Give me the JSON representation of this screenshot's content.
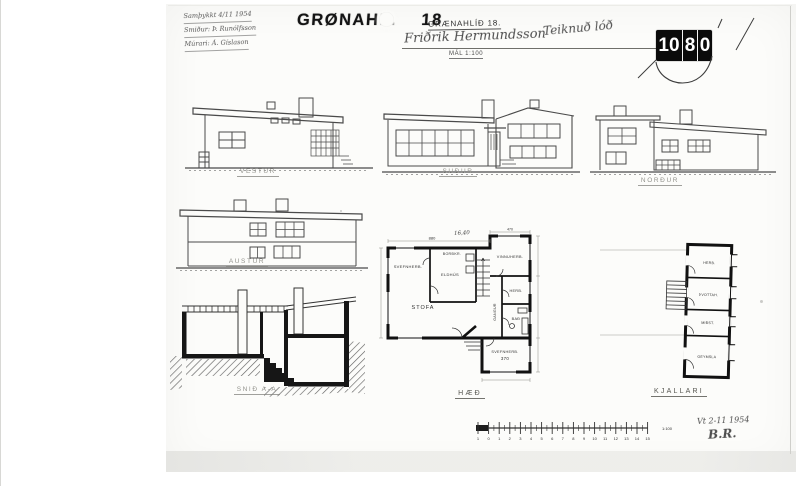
{
  "document": {
    "stamp": {
      "name": "GRØNAHL.",
      "number": "18"
    },
    "title_block": {
      "address": "GRÆNAHLÍÐ 18.",
      "owner": "Friðrik Hermundsson",
      "scale_note": "MÁL 1:100",
      "side_note": "Teiknuð lóð"
    },
    "approval_notes": {
      "line1": "Samþykkt 4/11 1954",
      "line2": "Smiður: Þ. Runólfsson",
      "line3": "Múrari: Á. Gíslason"
    },
    "plate_number": {
      "d1": "10",
      "d2": "8",
      "d3": "0"
    },
    "signature": {
      "date": "Vt 2-11 1954",
      "initials": "B.R."
    }
  },
  "drawings": {
    "elevations": [
      {
        "label": "VESTUR"
      },
      {
        "label": "SUÐUR"
      },
      {
        "label": "NORÐUR"
      },
      {
        "label": "AUSTUR"
      }
    ],
    "section": {
      "label": "SNIÐ A-A"
    },
    "floor_plan": {
      "label": "HÆÐ",
      "rooms": [
        {
          "name": "SVEFNHERB."
        },
        {
          "name": "BORÐKR."
        },
        {
          "name": "ELDHÚS"
        },
        {
          "name": "STOFA"
        },
        {
          "name": "VINNUHERB."
        },
        {
          "name": "HERB."
        },
        {
          "name": "BAÐ"
        },
        {
          "name": "GANGUR"
        },
        {
          "name": "SVEFNHERB.",
          "dim": "370"
        }
      ],
      "dimensions": {
        "top": "880",
        "top_hand": "16,40",
        "wing_top": "470"
      }
    },
    "basement_plan": {
      "label": "KJALLARI",
      "rooms": [
        {
          "name": "HERB."
        },
        {
          "name": "ÞVOTTAH."
        },
        {
          "name": "MIÐST."
        },
        {
          "name": "GEYMSLA"
        }
      ]
    }
  },
  "scale_bar": {
    "numbers": [
      "1",
      "0",
      "1",
      "2",
      "3",
      "4",
      "5",
      "6",
      "7",
      "8",
      "9",
      "10",
      "11",
      "12",
      "13",
      "14",
      "15"
    ],
    "ratio": "1:100"
  }
}
